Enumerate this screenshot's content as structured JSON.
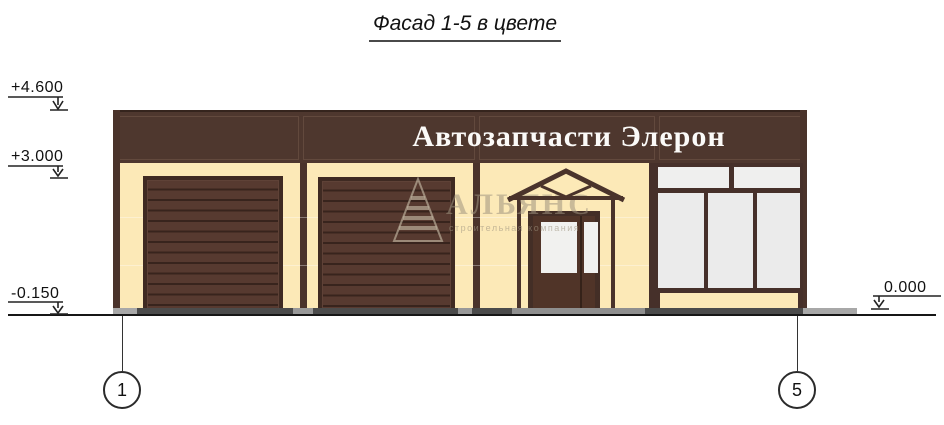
{
  "drawing": {
    "title": "Фасад 1-5 в цвете",
    "sign_text": "Автозапчасти Элерон",
    "elevation_marks": {
      "roof": "+4.600",
      "storefront": "+3.000",
      "ground": "-0.150",
      "entrance_level": "0.000"
    },
    "axis_markers": {
      "left": "1",
      "right": "5"
    },
    "watermark": {
      "name": "АЛЬЯНС",
      "subtitle": "строительная компания"
    },
    "colors": {
      "band_brown": "#4e372e",
      "wall_cream": "#fce9b7",
      "door_slat_brown": "#573a30",
      "frame_dark": "#3f2a22",
      "glass_gray": "#ebebeb",
      "sidewalk_dark": "#4b4b4b",
      "sidewalk_light": "#a8a8a8",
      "line_black": "#161616"
    }
  }
}
